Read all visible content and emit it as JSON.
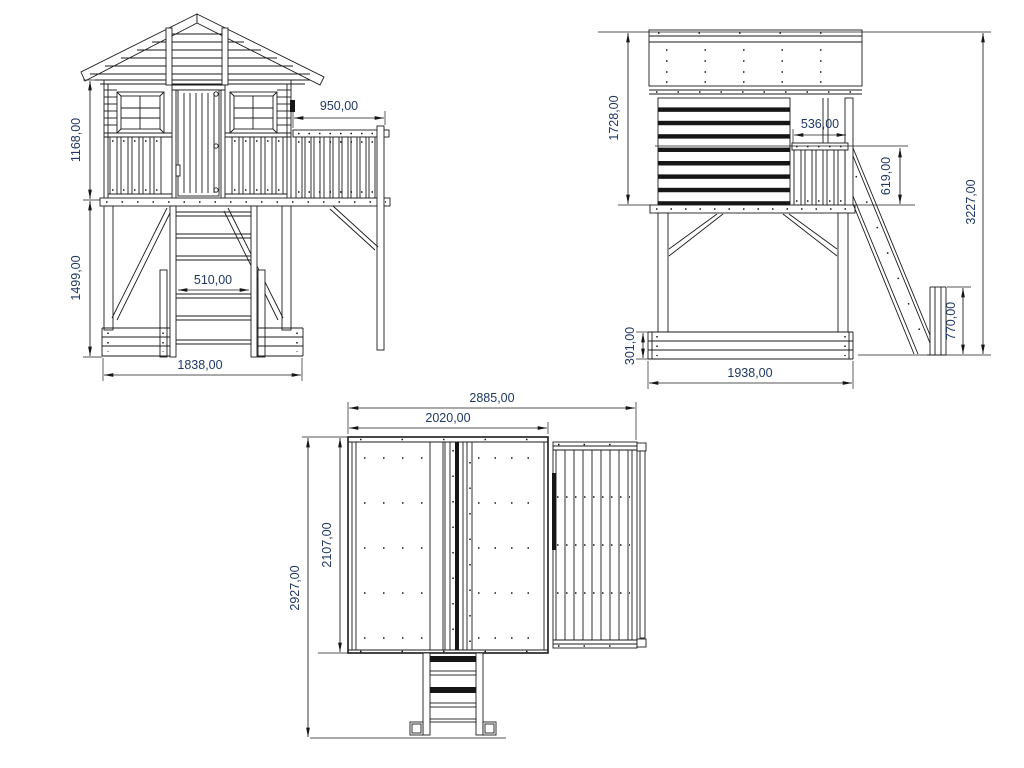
{
  "colors": {
    "line": "#1b1b1b",
    "dim_text": "#1f3864",
    "background": "#ffffff"
  },
  "views": {
    "front": {
      "dims": {
        "wall_height": "1168,00",
        "leg_height": "1499,00",
        "balcony_width": "950,00",
        "ladder_width": "510,00",
        "base_width": "1838,00"
      }
    },
    "side": {
      "dims": {
        "house_height": "1728,00",
        "balcony_depth": "536,00",
        "railing_height": "619,00",
        "total_height": "3227,00",
        "base_height": "301,00",
        "slide_end_height": "770,00",
        "base_depth": "1938,00"
      }
    },
    "plan": {
      "dims": {
        "total_width": "2885,00",
        "roof_width": "2020,00",
        "roof_depth": "2107,00",
        "total_depth": "2927,00"
      }
    }
  }
}
